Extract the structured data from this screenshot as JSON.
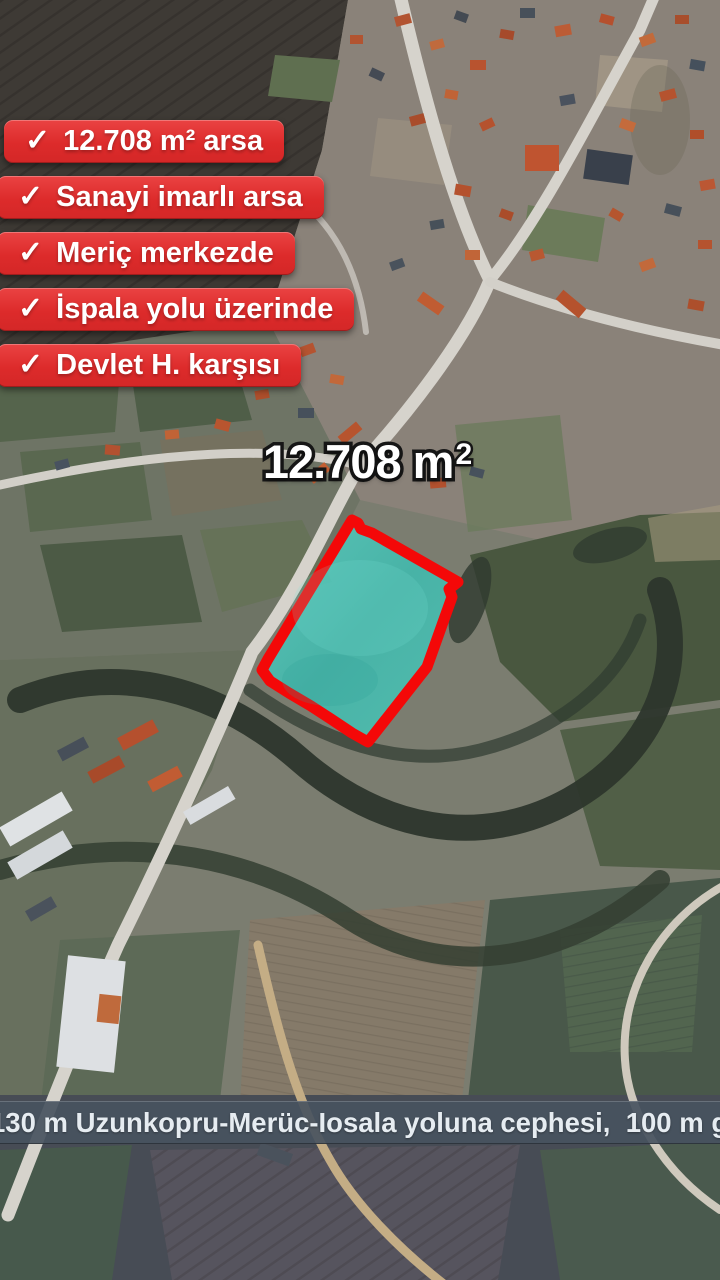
{
  "overlay": {
    "badges": [
      {
        "check": "✓",
        "label": "12.708 m² arsa"
      },
      {
        "check": "✓",
        "label": "Sanayi imarlı arsa"
      },
      {
        "check": "✓",
        "label": "Meriç merkezde"
      },
      {
        "check": "✓",
        "label": "İspala yolu üzerinde"
      },
      {
        "check": "✓",
        "label": "Devlet H. karşısı"
      }
    ],
    "area_label": {
      "base": "12.708 m",
      "sup": "2"
    },
    "bottom_bar": {
      "text": "130 m Uzunkopru-Merüc-Iosala yoluna cephesi,  100 m genişliğ"
    }
  },
  "colors": {
    "badge_red": "#dd2b2b",
    "plot_outline_red": "#f40808",
    "plot_fill_turquoise": "#45c4b8",
    "bar_background": "#48525f",
    "bar_text": "#e6ecf1",
    "label_text": "#ffffff",
    "label_outline": "#171717"
  }
}
